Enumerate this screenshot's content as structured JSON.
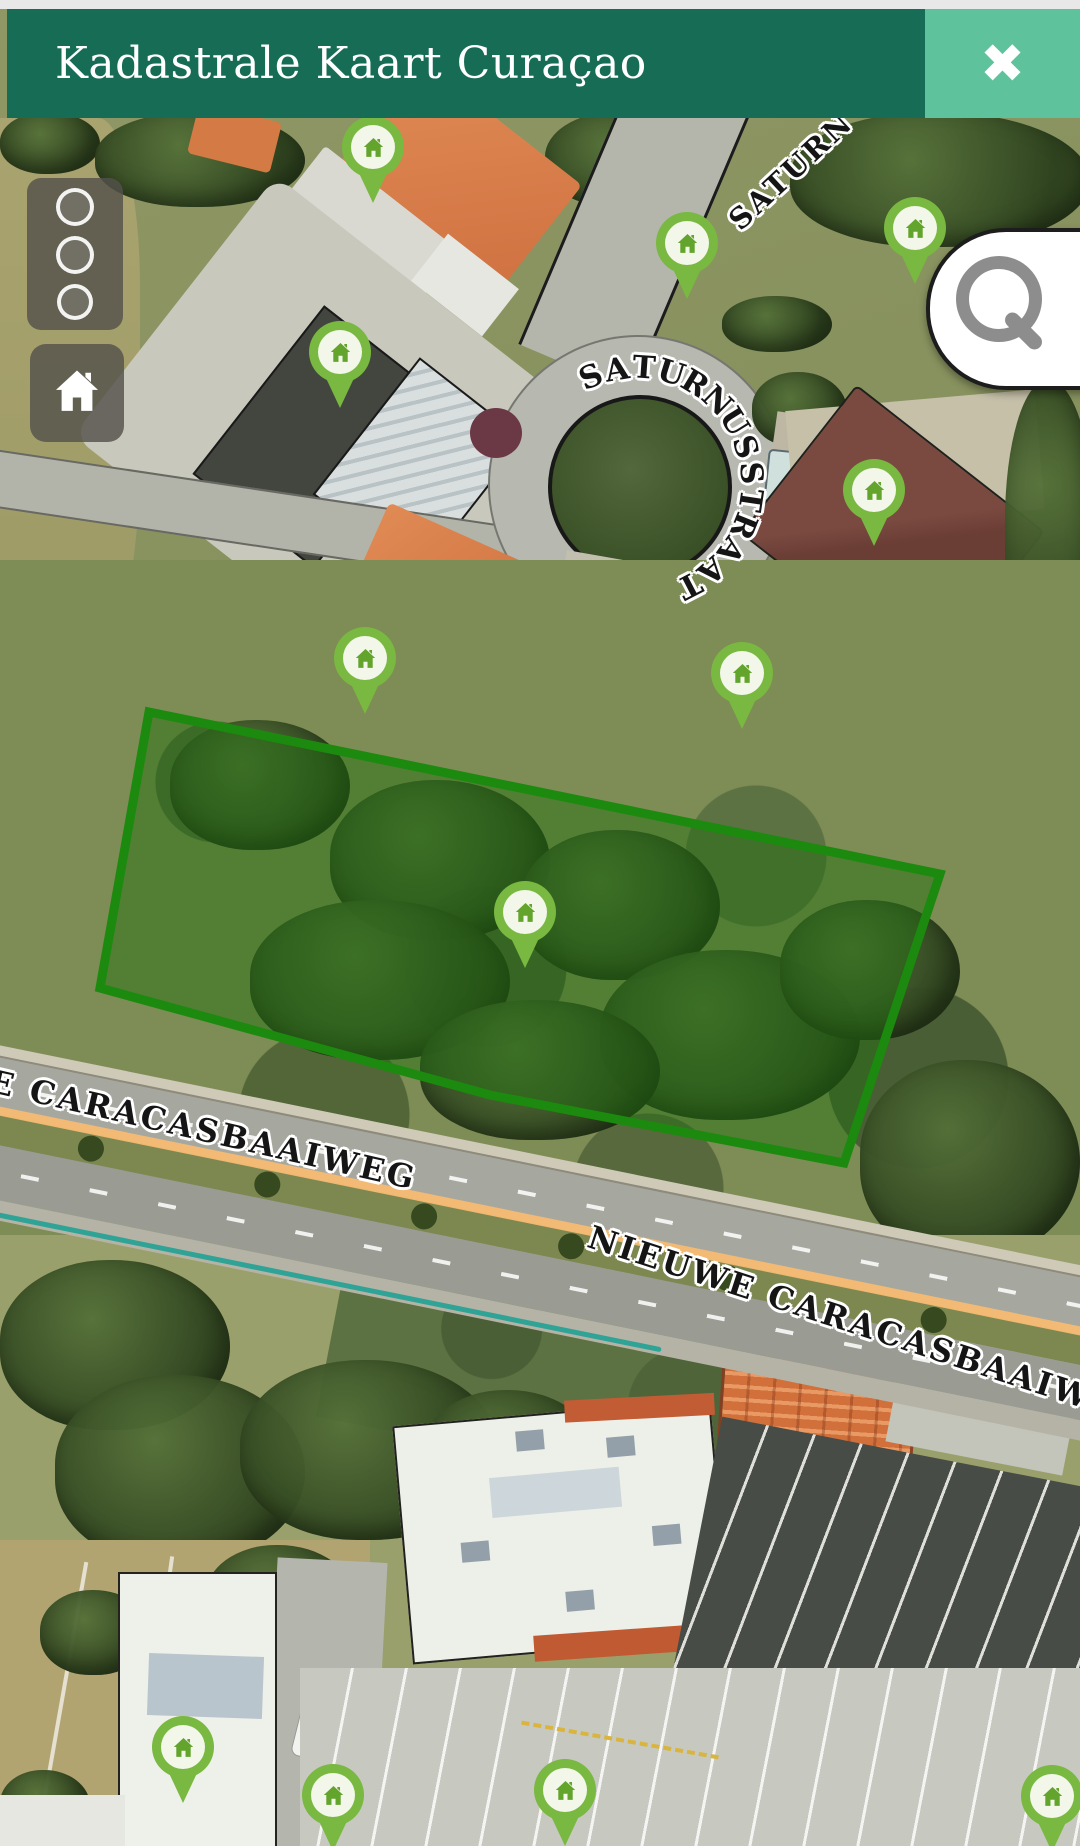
{
  "header": {
    "title": "Kadastrale Kaart Curaçao",
    "close_icon": "✖",
    "bg_color": "#176C55",
    "close_bg_color": "#5EC29D"
  },
  "controls": {
    "panel_buttons": [
      {
        "label": "layer-option-1"
      },
      {
        "label": "layer-option-2"
      },
      {
        "label": "layer-option-3"
      }
    ],
    "home_icon": "home",
    "search_icon": "magnifier"
  },
  "map": {
    "colors": {
      "pin": "#79B841",
      "pin_house": "#63A42D",
      "parcel_stroke": "#1C8A0F",
      "parcel_fill": "rgba(30,110,16,0.45)",
      "route_line": "#F5BB72",
      "boundary_line": "#2EA396"
    },
    "curved_street_label": {
      "text": "SATURNUSSTRAAT",
      "cx": 636,
      "cy": 483,
      "radius": 115,
      "start_angle": 247,
      "step": 13.5
    },
    "street_labels": [
      {
        "name": "street-label-saturnusstraat-north",
        "text": "SATURN",
        "x": 722,
        "y": 212,
        "rotation": -43,
        "font_size": 29
      },
      {
        "name": "street-label-caracasbaaiweg-west",
        "text": "E CARACASBAAIWEG",
        "x": -6,
        "y": 1062,
        "rotation": 13,
        "font_size": 32
      },
      {
        "name": "street-label-caracasbaaiweg-east",
        "text": "NIEUWE CARACASBAAIWEG",
        "x": 595,
        "y": 1218,
        "rotation": 18,
        "font_size": 32
      }
    ],
    "markers": [
      {
        "x": 373,
        "y": 147
      },
      {
        "x": 687,
        "y": 243
      },
      {
        "x": 915,
        "y": 228
      },
      {
        "x": 340,
        "y": 352
      },
      {
        "x": 874,
        "y": 490
      },
      {
        "x": 365,
        "y": 658
      },
      {
        "x": 742,
        "y": 673
      },
      {
        "x": 525,
        "y": 912
      },
      {
        "x": 183,
        "y": 1747
      },
      {
        "x": 333,
        "y": 1795
      },
      {
        "x": 565,
        "y": 1790
      },
      {
        "x": 1052,
        "y": 1796
      }
    ],
    "parcel": {
      "points": "149,712 940,874 844,1163 490,1095 100,988",
      "stroke_width": 9
    }
  }
}
